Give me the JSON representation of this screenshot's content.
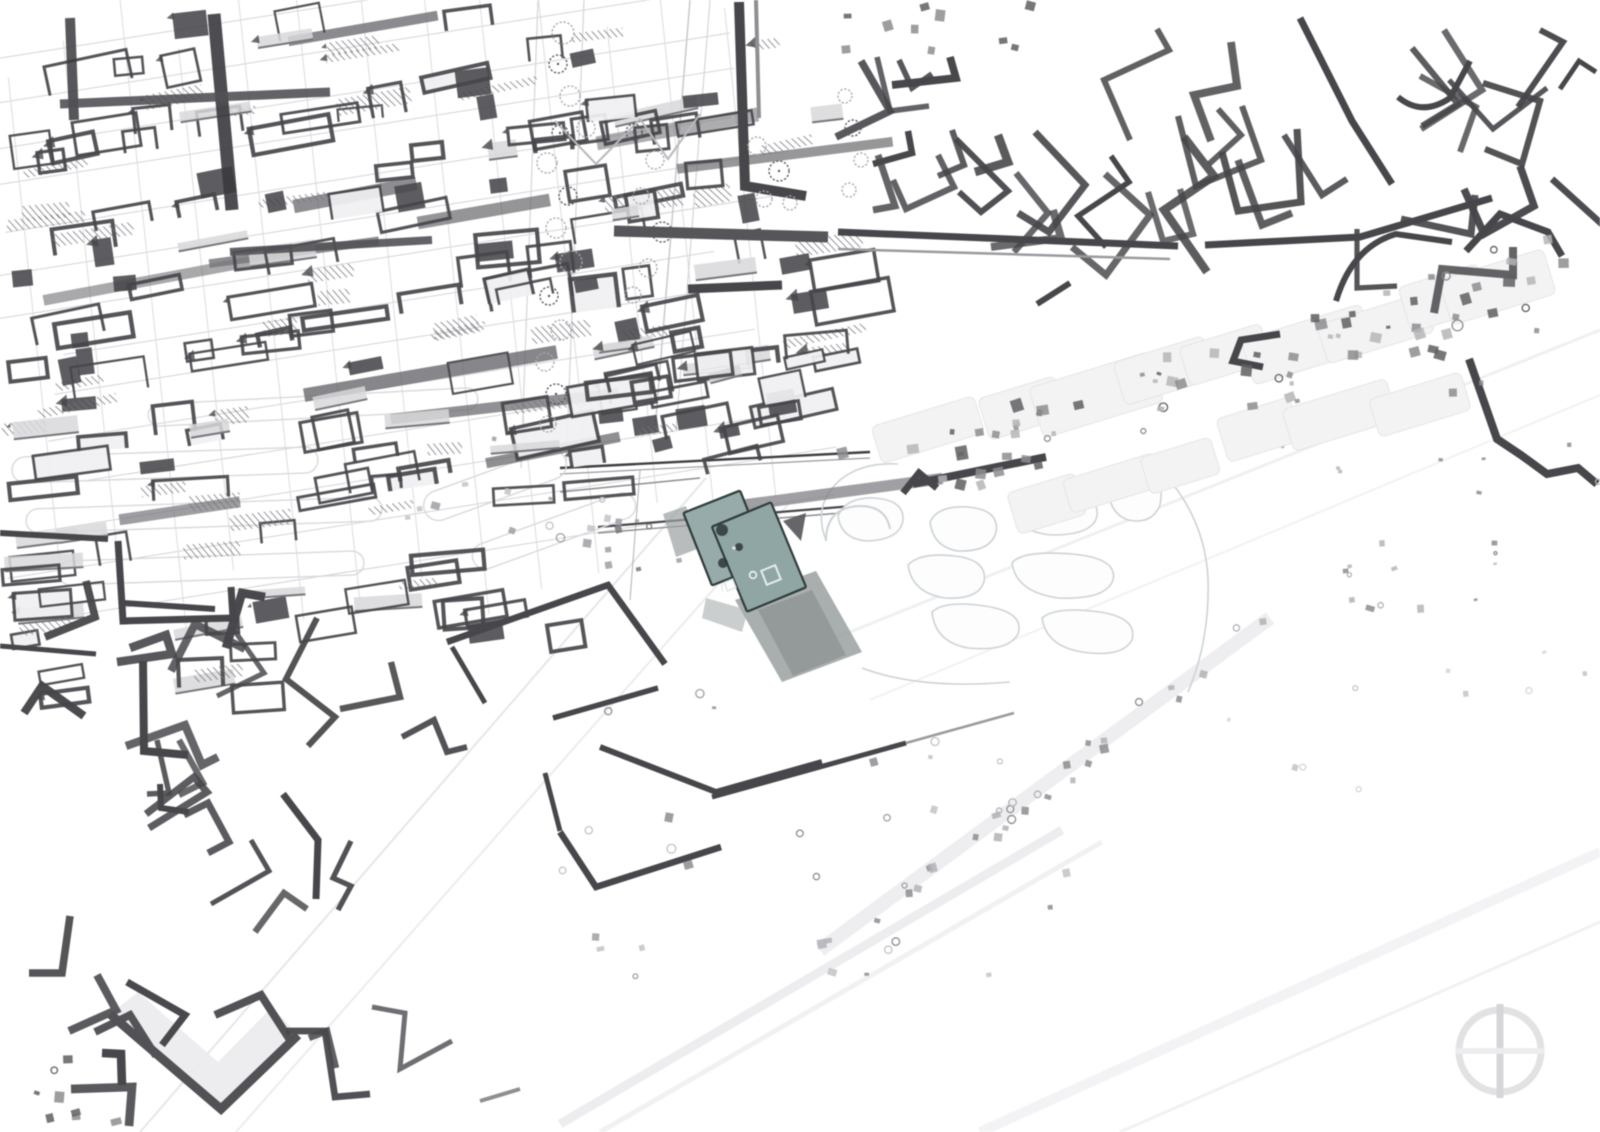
{
  "app": {
    "view_title": ""
  },
  "colors": {
    "bg": "#ffffff",
    "ink_dark": "#47474b",
    "ink_mid": "#77777c",
    "ink_light": "#b7b7bb",
    "slab": "#d8d8db",
    "hatch_line": "#74747a",
    "street": "#d4d4d8",
    "casing": "#d9d9dc",
    "park": "#ccd3d6",
    "park_fill": "#fdfdfe",
    "band_fill": "#f3f3f4",
    "band_stroke": "#e5e5e7",
    "highlight_fill": "#90a6a4",
    "highlight_fill_back": "#96abaa",
    "highlight_stroke": "#2f3c3b",
    "shadow_main": "#9aa0a0",
    "shadow_dark": "#878d8e",
    "compass_ring": "#e2e2e4",
    "compass_axis": "#d6d6d9",
    "compass_cross": "#ececee"
  },
  "map": {
    "width": 1600,
    "height": 1132,
    "viewbox": "0 0 1600 1132",
    "streets": [
      {
        "cx": 385,
        "cy": 280,
        "angle": -9,
        "count": 14,
        "spacing": 43,
        "len": 880,
        "color": "#d4d4d8",
        "width": 1,
        "seed": 11
      },
      {
        "cx": 390,
        "cy": 290,
        "angle": 84,
        "count": 13,
        "spacing": 60,
        "len": 680,
        "color": "#dcdcdf",
        "width": 1,
        "seed": 12
      }
    ],
    "roads": [
      [
        140,
        1132,
        706,
        478,
        "#e6e6e9",
        2,
        1
      ],
      [
        236,
        1132,
        792,
        500,
        "#ececef",
        2,
        1
      ],
      [
        560,
        1124,
        1062,
        830,
        "#ededf0",
        9,
        1
      ],
      [
        600,
        1132,
        1102,
        842,
        "#f1f1f3",
        5,
        1
      ],
      [
        980,
        1132,
        1600,
        852,
        "#f3f3f5",
        10,
        1
      ],
      [
        1120,
        1132,
        1600,
        922,
        "#f1f1f4",
        3,
        1
      ],
      [
        830,
        640,
        1600,
        330,
        "#f0f0f2",
        3,
        1
      ],
      [
        870,
        700,
        1600,
        395,
        "#f2f2f4",
        2,
        1
      ],
      [
        820,
        950,
        1270,
        618,
        "#ededef",
        14,
        0.9
      ],
      [
        538,
        0,
        521,
        468,
        "#d8d8db",
        1.3,
        1
      ],
      [
        584,
        0,
        566,
        470,
        "#d8d8db",
        1.3,
        1
      ],
      [
        690,
        0,
        655,
        430,
        "#c9c9cd",
        1.5,
        1
      ],
      [
        710,
        0,
        676,
        430,
        "#d5d5d9",
        1.2,
        1
      ],
      [
        640,
        470,
        630,
        600,
        "#b0b0b4",
        1,
        1
      ],
      [
        560,
        468,
        870,
        452,
        "#3f3f43",
        2.4,
        1
      ],
      [
        560,
        474,
        870,
        458,
        "#9a9a9e",
        1.2,
        1
      ],
      [
        598,
        527,
        865,
        505,
        "#47474b",
        2.2,
        1
      ],
      [
        598,
        533,
        865,
        511,
        "#8d8d91",
        1.4,
        1
      ],
      [
        560,
        492,
        700,
        478,
        "#8d8d91",
        1.5,
        1
      ]
    ],
    "casings": [
      [
        12,
        452,
        306,
        26,
        -2
      ],
      [
        26,
        503,
        356,
        24,
        -2
      ],
      [
        148,
        396,
        330,
        22,
        -3
      ],
      [
        58,
        556,
        306,
        24,
        -2
      ],
      [
        420,
        470,
        150,
        30,
        -20
      ],
      [
        468,
        518,
        172,
        26,
        -20
      ]
    ],
    "park_paths": [
      {
        "d": "M838,516 Q846,497 874,498 Q905,500 903,521 Q899,540 867,541 Q841,539 838,516 Z",
        "closed": true
      },
      {
        "d": "M930,522 Q938,505 968,507 Q1000,510 996,532 Q991,552 958,551 Q933,547 930,522 Z",
        "closed": true
      },
      {
        "d": "M1012,505 Q1020,490 1060,492 Q1100,494 1097,516 Q1093,535 1052,535 Q1015,532 1012,505 Z",
        "closed": true
      },
      {
        "d": "M1108,474 Q1125,462 1148,470 Q1165,480 1160,505 Q1152,525 1128,520 Q1105,512 1108,474 Z",
        "closed": true
      },
      {
        "d": "M908,565 Q920,552 955,556 Q988,560 984,582 Q978,600 945,598 Q912,593 908,565 Z",
        "closed": true
      },
      {
        "d": "M1012,563 Q1022,550 1072,554 Q1118,558 1113,580 Q1106,600 1058,598 Q1016,592 1012,563 Z",
        "closed": true
      },
      {
        "d": "M932,612 Q945,600 985,606 Q1025,612 1018,634 Q1008,652 968,648 Q935,642 932,612 Z",
        "closed": true
      },
      {
        "d": "M1042,618 Q1056,606 1100,612 Q1138,618 1132,640 Q1122,658 1082,652 Q1046,646 1042,618 Z",
        "closed": true
      },
      {
        "d": "M826,540 Q812,505 840,480 Q862,462 898,464",
        "closed": false
      },
      {
        "d": "M1168,478 Q1205,522 1208,578 Q1210,640 1188,692",
        "closed": false
      },
      {
        "d": "M862,668 Q920,690 1010,682",
        "closed": false
      }
    ],
    "blur_rows": [
      {
        "line": [
          905,
          432,
          1545,
          272
        ],
        "n": 9,
        "w": [
          80,
          130
        ],
        "h": [
          38,
          56
        ],
        "angle": -17,
        "seed": 39
      },
      {
        "line": [
          1005,
          505,
          1455,
          390
        ],
        "n": 6,
        "w": [
          70,
          110
        ],
        "h": [
          32,
          48
        ],
        "angle": -17,
        "seed": 40
      }
    ],
    "grids": [
      {
        "name": "cluster-top-left",
        "region": [
          0,
          4,
          812,
          428
        ],
        "n": 150,
        "angle": -9,
        "jitter": 4,
        "w": [
          26,
          86
        ],
        "h": [
          12,
          34
        ],
        "seed": 35
      },
      {
        "name": "cluster-mid-left",
        "region": [
          0,
          420,
          572,
          218
        ],
        "n": 46,
        "angle": -7,
        "jitter": 4,
        "w": [
          26,
          80
        ],
        "h": [
          12,
          30
        ],
        "seed": 36
      },
      {
        "name": "cluster-center-top",
        "region": [
          580,
          300,
          240,
          160
        ],
        "n": 22,
        "angle": -10,
        "jitter": 5,
        "w": [
          22,
          66
        ],
        "h": [
          12,
          28
        ],
        "seed": 37
      },
      {
        "name": "cluster-left-lower",
        "region": [
          0,
          560,
          240,
          140
        ],
        "n": 12,
        "angle": -6,
        "jitter": 4,
        "w": [
          24,
          70
        ],
        "h": [
          12,
          28
        ],
        "seed": 38
      }
    ],
    "bars": {
      "region": [
        30,
        30,
        750,
        520
      ],
      "n": 12,
      "angle": -9,
      "len": [
        120,
        260
      ],
      "th": [
        8,
        14
      ],
      "seed": 34
    },
    "thick_l": [
      {
        "name": "cluster-bottom-left",
        "region": [
          0,
          620,
          430,
          500
        ],
        "n": 26,
        "base": -25,
        "spread": 50,
        "seg": [
          18,
          70
        ],
        "w": [
          5,
          9
        ],
        "seed": 31
      },
      {
        "name": "cluster-top-right",
        "region": [
          835,
          8,
          460,
          215
        ],
        "n": 24,
        "base": 62,
        "spread": 22,
        "seg": [
          22,
          75
        ],
        "w": [
          5.5,
          8.5
        ],
        "seed": 32
      },
      {
        "name": "cluster-right-top",
        "region": [
          1305,
          5,
          290,
          255
        ],
        "n": 11,
        "base": 55,
        "spread": 45,
        "seg": [
          25,
          80
        ],
        "w": [
          5,
          8
        ],
        "seed": 33
      }
    ],
    "fills": [
      {
        "pts": "110,1014 221,1109 298,1035 272,1007 218,1062 138,992",
        "fill": "#ebebed",
        "o": 0.9
      },
      {
        "pts": "783,521 806,513 801,541",
        "fill": "#55555a",
        "o": 0.9
      }
    ],
    "hand_shapes": [
      {
        "d": "M214,14 L232,210",
        "w": 13,
        "c": "#3a3a3e",
        "o": 0.9
      },
      {
        "d": "M70,18 L74,120",
        "w": 10,
        "c": "#3a3a3e",
        "o": 0.85
      },
      {
        "d": "M60,104 L330,92",
        "w": 9,
        "c": "#515156",
        "o": 0.9
      },
      {
        "d": "M230,252 L432,240",
        "w": 8,
        "c": "#515156",
        "o": 0.9
      },
      {
        "d": "M739,2 L745,186 L806,196",
        "w": 10
      },
      {
        "d": "M756,0 L759,118",
        "w": 4,
        "c": "#8f8f93"
      },
      {
        "d": "M614,231 L828,237",
        "w": 11,
        "c": "#55555a"
      },
      {
        "d": "M688,289 L782,285",
        "w": 9
      },
      {
        "d": "M838,232 L1178,246",
        "w": 7
      },
      {
        "d": "M838,249 L1170,259",
        "w": 2.5,
        "c": "#9b9b9f"
      },
      {
        "d": "M1205,245 L1360,237 L1492,198",
        "w": 7
      },
      {
        "d": "M555,121 L596,164 L640,119 L668,159 L700,114",
        "w": 2,
        "c": "#b9b9bd"
      },
      {
        "d": "M1300,18 L1352,121 L1392,184",
        "w": 7
      },
      {
        "d": "M1398,97 Q1422,117 1450,98 L1470,61",
        "w": 6
      },
      {
        "d": "M1336,301 Q1352,247 1396,234 L1452,242",
        "w": 6
      },
      {
        "d": "M1560,89 L1579,61 L1596,72",
        "w": 5
      },
      {
        "d": "M1466,251 L1500,214 L1548,232 L1562,256",
        "w": 7
      },
      {
        "d": "M1280,334 L1241,340 L1233,361 L1263,367",
        "w": 7
      },
      {
        "d": "M913,484 L1046,457",
        "w": 8
      },
      {
        "d": "M903,493 L919,473 L937,488",
        "w": 7
      },
      {
        "d": "M1037,304 L1070,283",
        "w": 6
      },
      {
        "d": "M1469,359 L1497,439 L1521,455 L1547,474 L1578,468 L1597,484",
        "w": 8
      },
      {
        "d": "M118,541 L123,621 L233,618 L231,587",
        "w": 7
      },
      {
        "d": "M0,533 L108,539",
        "w": 6
      },
      {
        "d": "M447,642 L608,585 L665,664",
        "w": 6.5
      },
      {
        "d": "M452,647 L485,703",
        "w": 5
      },
      {
        "d": "M553,718 L658,688",
        "w": 5.5
      },
      {
        "d": "M560,832 L596,887 L721,847",
        "w": 6.5
      },
      {
        "d": "M600,747 L716,792 L822,762",
        "w": 6
      },
      {
        "d": "M545,773 L560,831",
        "w": 5
      },
      {
        "d": "M712,797 L906,743",
        "w": 5
      },
      {
        "d": "M906,743 L1014,713",
        "w": 2.5,
        "c": "#9b9b9f"
      },
      {
        "d": "M143,661 L144,751 L188,755",
        "w": 8
      },
      {
        "d": "M160,784 L161,808 L189,812",
        "w": 6
      },
      {
        "d": "M283,794 L318,840 L316,899",
        "w": 7
      },
      {
        "d": "M110,1014 L221,1109 L298,1035",
        "w": 9,
        "c": "#515156"
      },
      {
        "d": "M0,646 L96,654",
        "w": 5
      },
      {
        "d": "M372,1007 L405,1013 L400,1069 L452,1041",
        "w": 5,
        "c": "#6f6f73"
      },
      {
        "d": "M480,1101 L520,1089",
        "w": 4,
        "c": "#8f8f93"
      },
      {
        "d": "M123,603 L215,609",
        "w": 6
      },
      {
        "d": "M826,541 Q826,507 860,506 Q886,506 890,529",
        "w": 2,
        "c": "#cdd2d4"
      }
    ],
    "trees": [
      [
        563,
        33,
        11,
        0
      ],
      [
        558,
        64,
        9,
        1
      ],
      [
        570,
        96,
        10,
        0
      ],
      [
        586,
        128,
        9,
        0
      ],
      [
        560,
        133,
        8,
        1
      ],
      [
        547,
        163,
        10,
        0
      ],
      [
        568,
        196,
        9,
        1
      ],
      [
        556,
        228,
        10,
        0
      ],
      [
        571,
        262,
        11,
        0
      ],
      [
        549,
        296,
        9,
        1
      ],
      [
        561,
        330,
        10,
        0
      ],
      [
        545,
        362,
        9,
        0
      ],
      [
        556,
        394,
        10,
        1
      ],
      [
        548,
        424,
        8,
        0
      ],
      [
        634,
        132,
        8,
        1
      ],
      [
        655,
        160,
        9,
        0
      ],
      [
        641,
        196,
        8,
        0
      ],
      [
        662,
        232,
        10,
        1
      ],
      [
        648,
        268,
        9,
        0
      ],
      [
        633,
        295,
        8,
        0
      ],
      [
        757,
        146,
        9,
        0
      ],
      [
        779,
        171,
        10,
        1
      ],
      [
        764,
        199,
        8,
        0
      ],
      [
        790,
        203,
        7,
        0
      ],
      [
        845,
        96,
        7,
        0
      ],
      [
        853,
        128,
        8,
        1
      ],
      [
        861,
        160,
        7,
        0
      ],
      [
        849,
        190,
        7,
        0
      ]
    ],
    "specks": [
      {
        "name": "band-specks",
        "line": [
          880,
          470,
          1580,
          270
        ],
        "n": 75,
        "sigma": 55,
        "size": [
          4,
          12
        ],
        "seed": 21,
        "palette": [
          "#5f5f63",
          "#8d8d91",
          "#b5b5b9"
        ],
        "circle": 0.15
      },
      {
        "name": "right-specks",
        "region": [
          1280,
          300,
          320,
          340
        ],
        "n": 20,
        "size": [
          3,
          9
        ],
        "seed": 22,
        "palette": [
          "#8d8d91",
          "#b5b5b9"
        ],
        "circle": 0.2
      },
      {
        "name": "bottom-specks",
        "region": [
          560,
          690,
          520,
          310
        ],
        "n": 28,
        "size": [
          4,
          9
        ],
        "seed": 23,
        "palette": [
          "#8d8d91",
          "#9f9fa3",
          "#c3c3c7"
        ],
        "circle": 0.45
      },
      {
        "name": "avenue-specks",
        "line": [
          820,
          950,
          1270,
          618
        ],
        "n": 30,
        "sigma": 16,
        "size": [
          5,
          9
        ],
        "seed": 24,
        "palette": [
          "#8d8d91",
          "#b3b3b7"
        ],
        "circle": 0.2
      },
      {
        "name": "corner-specks",
        "region": [
          0,
          1040,
          120,
          90
        ],
        "n": 8,
        "size": [
          5,
          11
        ],
        "seed": 25,
        "palette": [
          "#5f5f63",
          "#8d8d91"
        ],
        "circle": 0.1
      },
      {
        "name": "hatch-specks",
        "region": [
          400,
          430,
          215,
          130
        ],
        "n": 14,
        "size": [
          4,
          9
        ],
        "seed": 26,
        "palette": [
          "#9f9fa3",
          "#c3c3c7"
        ],
        "circle": 0.1
      },
      {
        "name": "edge-specks",
        "region": [
          596,
          518,
          96,
          62
        ],
        "n": 8,
        "size": [
          4,
          8
        ],
        "seed": 27,
        "palette": [
          "#9f9fa3",
          "#77777c"
        ],
        "circle": 0.1
      },
      {
        "name": "far-right-specks",
        "region": [
          1080,
          640,
          520,
          180
        ],
        "n": 10,
        "size": [
          3,
          7
        ],
        "seed": 28,
        "palette": [
          "#c3c3c7",
          "#d6d6d9"
        ],
        "circle": 0.3
      },
      {
        "name": "band-end-specks",
        "region": [
          1330,
          560,
          60,
          60
        ],
        "n": 6,
        "size": [
          4,
          9
        ],
        "seed": 29,
        "palette": [
          "#8d8d91",
          "#b3b3b7"
        ],
        "circle": 0.2
      },
      {
        "name": "top-edge-specks",
        "region": [
          840,
          0,
          200,
          50
        ],
        "n": 10,
        "size": [
          5,
          10
        ],
        "seed": 30,
        "palette": [
          "#5f5f63",
          "#8d8d91"
        ],
        "circle": 0.1
      }
    ],
    "highlight": {
      "shadows": [
        {
          "pts": "735,600 816,571 862,652 782,682",
          "fill": "#9aa0a0",
          "o": 0.85
        },
        {
          "pts": "758,610 812,590 846,655 793,676",
          "fill": "#878d8e",
          "o": 0.6
        },
        {
          "pts": "663,514 686,506 700,548 676,557",
          "fill": "#9ba0a1",
          "o": 0.7
        },
        {
          "pts": "706,598 748,610 742,632 702,618",
          "fill": "#a8adad",
          "o": 0.6
        }
      ],
      "rects": [
        {
          "cx": 726,
          "cy": 538,
          "w": 61,
          "h": 78,
          "a": -21.5,
          "back": true
        },
        {
          "cx": 759,
          "cy": 557,
          "w": 64,
          "h": 92,
          "a": -22.5,
          "back": false
        }
      ],
      "details": {
        "squares": [
          {
            "cx": 771,
            "cy": 575,
            "s": 15,
            "a": -22,
            "c": "#e6edeb",
            "w": 2
          },
          {
            "cx": 730,
            "cy": 585,
            "s": 9,
            "a": -22,
            "c": "#dde6e4",
            "w": 1.6
          }
        ],
        "circles": [
          {
            "cx": 753,
            "cy": 575,
            "r": 3.4,
            "c": "#eef3f1",
            "w": 1.6
          }
        ],
        "blobs": [
          [
            722,
            530,
            6
          ],
          [
            739,
            547,
            4
          ],
          [
            723,
            563,
            5
          ]
        ],
        "dot": [
          734,
          548,
          1.8
        ]
      }
    },
    "compass": {
      "cx": 1500,
      "cy": 1051,
      "r": 41
    }
  }
}
